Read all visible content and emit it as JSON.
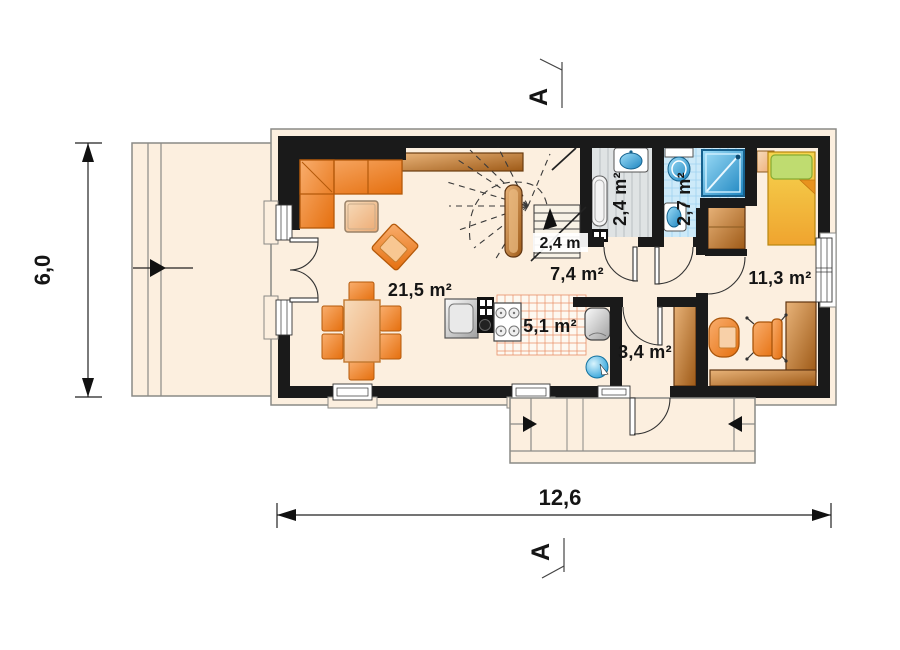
{
  "title": "House ground floor plan",
  "dimensions": {
    "width_label": "12,6",
    "height_label": "6,0"
  },
  "section_marker": {
    "label": "A"
  },
  "rooms": {
    "living": {
      "label": "21,5 m²"
    },
    "hall": {
      "label": "7,4 m²"
    },
    "wc": {
      "label": "2,4 m²"
    },
    "bathroom": {
      "label": "2,7 m²"
    },
    "bedroom": {
      "label": "11,3 m²"
    },
    "kitchen": {
      "label": "5,1 m²"
    },
    "entry": {
      "label": "3,4 m²"
    }
  },
  "annotations": {
    "stair_height": "2,4 m"
  },
  "colors": {
    "wall": "#1a1a1a",
    "floor": "#fcefdf",
    "outline_gray": "#8a8a86",
    "furniture_orange": "#ed7d18",
    "wood_brown": "#b96a22",
    "table_peach": "#f0b482",
    "bed_yellow": "#f5b93a",
    "pillow_green": "#b8d96e",
    "water_blue": "#2196d4",
    "bath_tile": "#cdeaf9",
    "wc_floor": "#dfe3e4",
    "kitchen_tile_line": "#e89068"
  }
}
